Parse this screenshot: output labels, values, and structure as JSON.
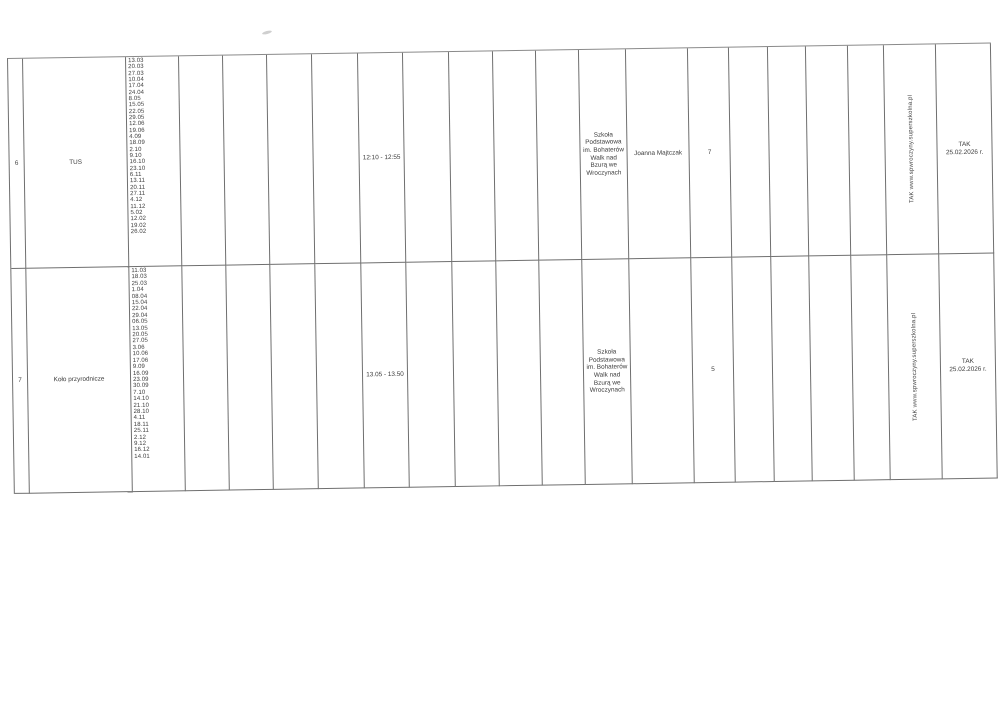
{
  "colors": {
    "line": "#6f6f6f",
    "text": "#3c3c3c",
    "paper": "#ffffff"
  },
  "table": {
    "rows": [
      {
        "no": "6",
        "activity": "TUS",
        "dates": [
          "13.03",
          "20.03",
          "27.03",
          "10.04",
          "17.04",
          "24.04",
          "8.05",
          "15.05",
          "22.05",
          "29.05",
          "12.06",
          "19.06",
          "4.09",
          "18.09",
          "2.10",
          "9.10",
          "16.10",
          "23.10",
          "6.11",
          "13.11",
          "20.11",
          "27.11",
          "4.12",
          "11.12",
          "5.02",
          "12.02",
          "19.02",
          "26.02"
        ],
        "time": "12:10 - 12:55",
        "school": "Szkoła Podstawowa im. Bohaterów Walk nad Bzurą we Wroczynach",
        "teacher": "Joanna Majtczak",
        "count": "7",
        "website": "TAK www.spwroczyny.superszkolna.pl",
        "confirmation": [
          "TAK",
          "25.02.2026 r."
        ]
      },
      {
        "no": "7",
        "activity": "Koło przyrodnicze",
        "dates": [
          "11.03",
          "18.03",
          "25.03",
          "1.04",
          "08.04",
          "15.04",
          "22.04",
          "29.04",
          "06.05",
          "13.05",
          "20.05",
          "27.05",
          "3.06",
          "10.06",
          "17.06",
          "9.09",
          "16.09",
          "23.09",
          "30.09",
          "7.10",
          "14.10",
          "21.10",
          "28.10",
          "4.11",
          "18.11",
          "25.11",
          "2.12",
          "9.12",
          "16.12",
          "14.01"
        ],
        "time": "13.05 - 13.50",
        "school": "Szkoła Podstawowa im. Bohaterów Walk nad Bzurą we Wroczynach",
        "teacher": "",
        "count": "5",
        "website": "TAK www.spwroczyny.superszkolna.pl",
        "confirmation": [
          "TAK",
          "25.02.2026 r."
        ]
      }
    ]
  }
}
